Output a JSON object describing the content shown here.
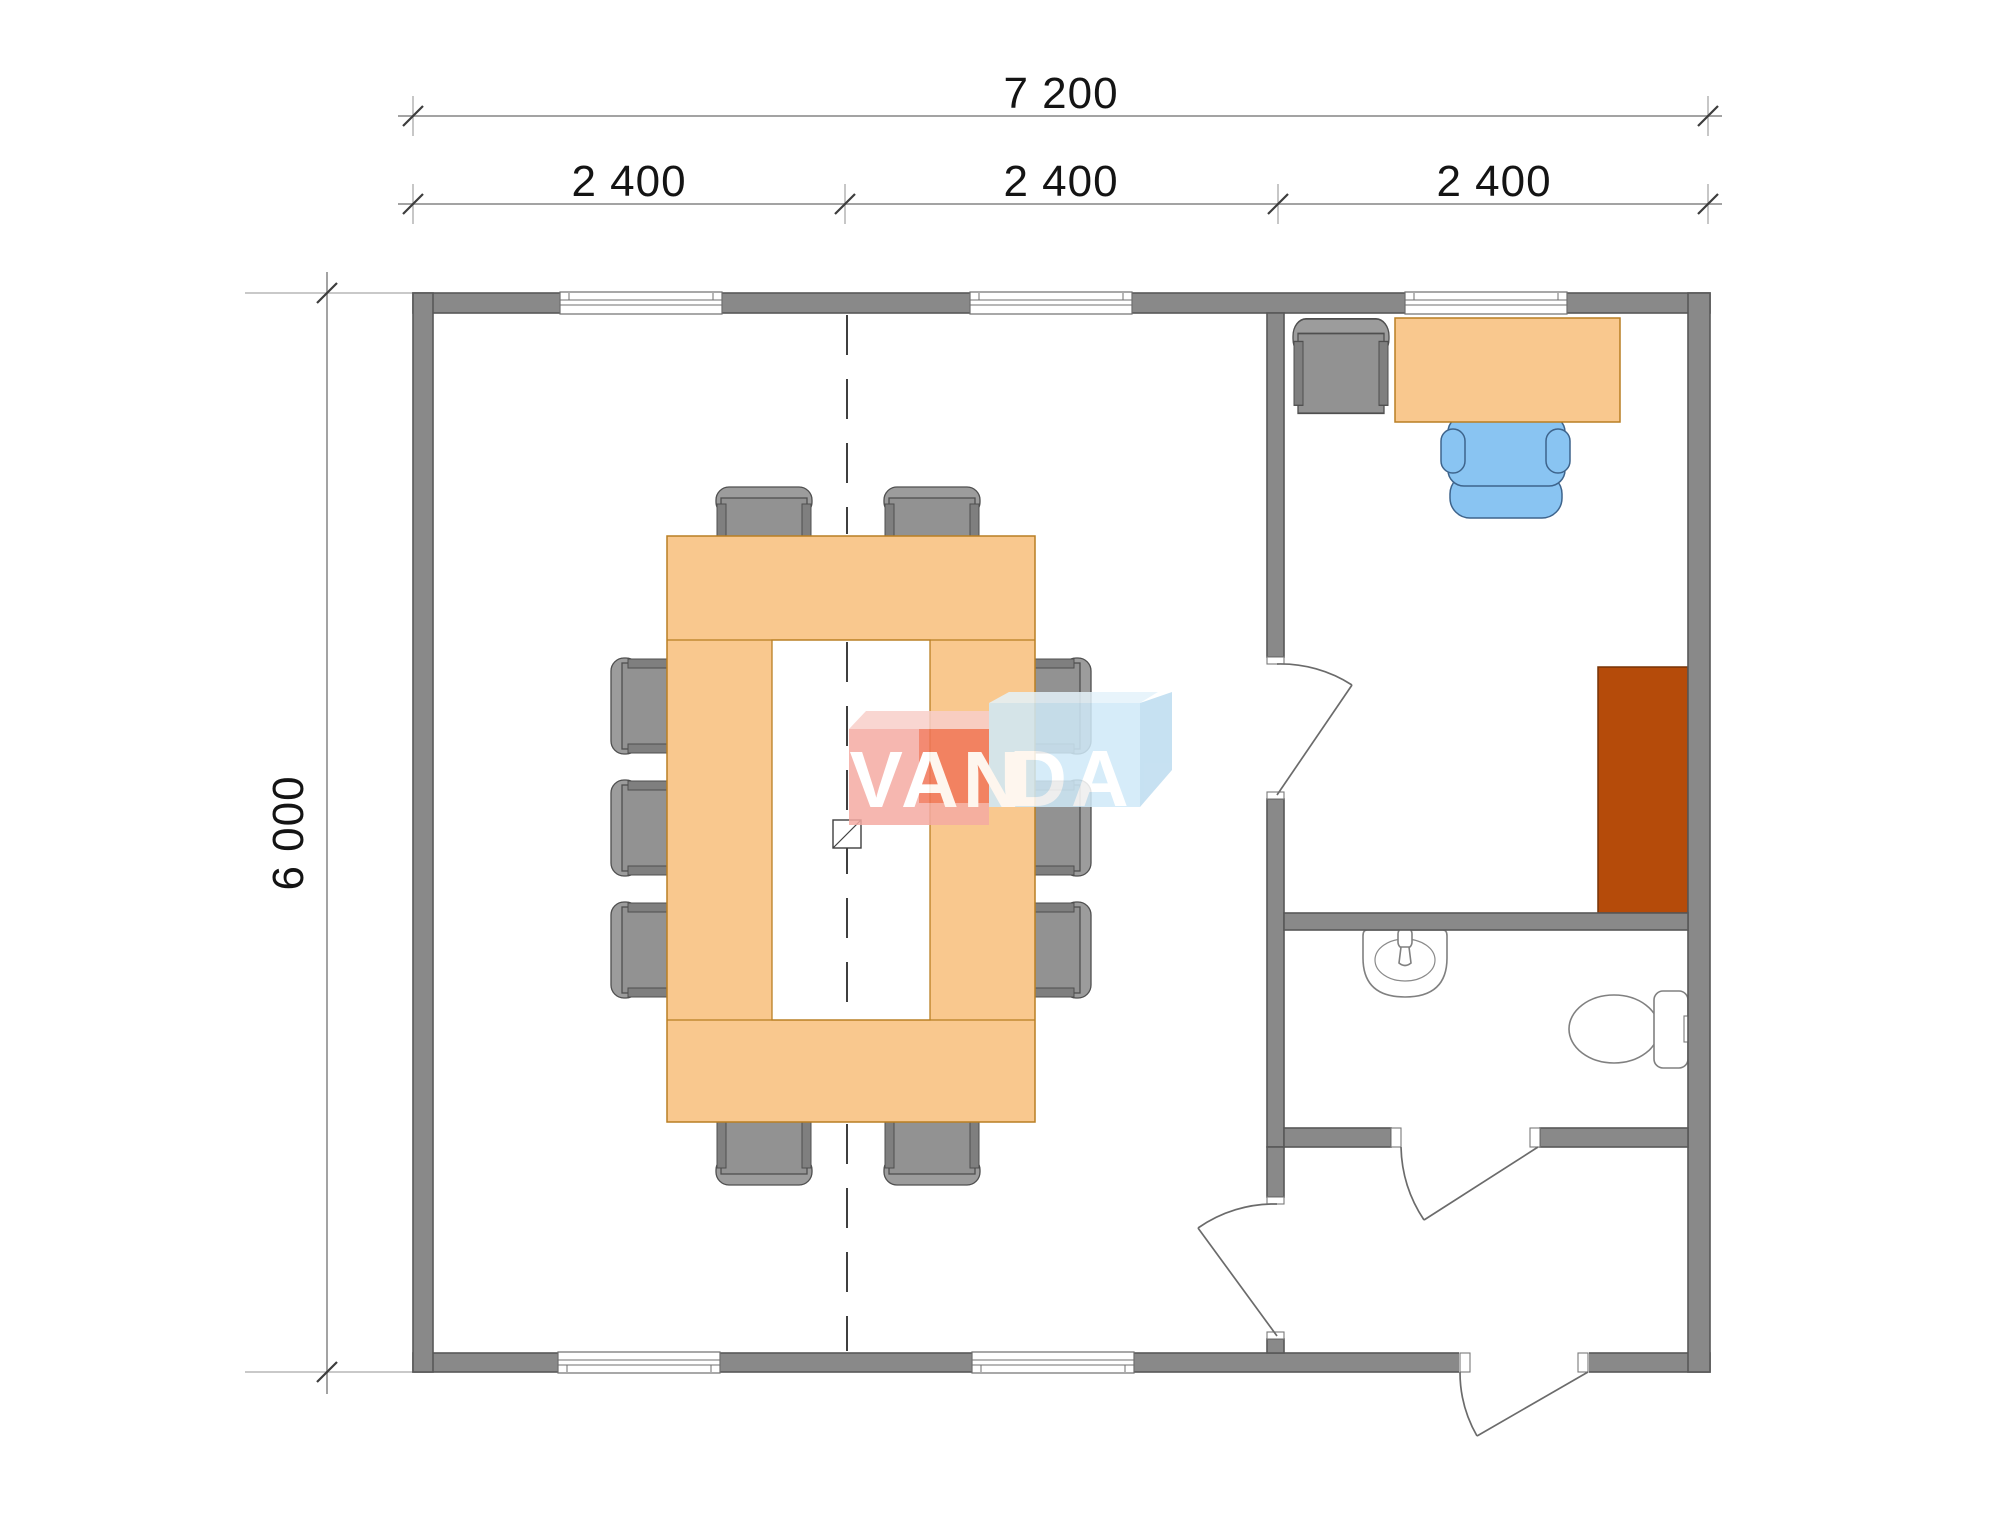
{
  "drawing": {
    "title": "Modular building floor plan 7200 x 6000",
    "dimensions": {
      "total_width": "7 200",
      "total_height": "6 000",
      "bays": [
        "2 400",
        "2 400",
        "2 400"
      ]
    },
    "brand": {
      "van": "VAN",
      "da": "DA"
    },
    "colors": {
      "wall": "#898989",
      "wall_outline": "#585858",
      "table_peach": "#f9c88e",
      "chair_gray": "#929292",
      "office_chair_blue": "#89c4f2",
      "cabinet_rust": "#b54b0a",
      "logo_pink": "#f5aba3",
      "logo_orange": "#f1765a",
      "logo_blue": "#cfe9f8",
      "dim_line_gray": "#a3a3a3",
      "text": "#141414"
    }
  }
}
